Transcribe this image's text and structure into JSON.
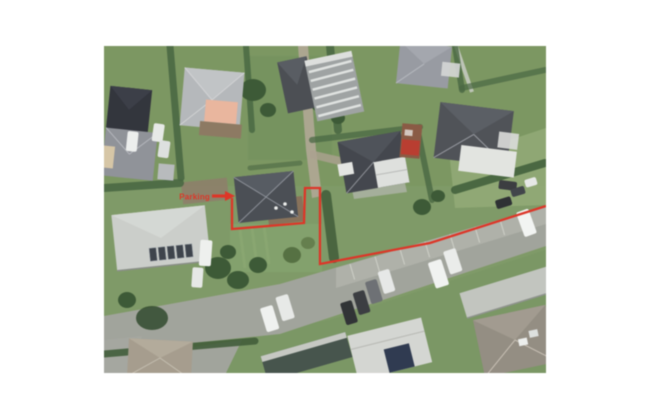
{
  "page": {
    "background_color": "#ffffff",
    "content_type": "aerial-photo-with-boundary-overlay"
  },
  "overlay": {
    "color": "#e93223",
    "label": "Parking",
    "boundary_points": "232,198 232,229 304,223 305,188 320,188 320,264 430,243 546,206",
    "arrow_shaft_points": "212,196 227,196",
    "arrow_head_points": "225,191 235,196 225,201"
  },
  "palette": {
    "grass": "#7e9b64",
    "grass_light": "#93ae74",
    "road": "#a2a59c",
    "parking_strip": "#b0b2a9",
    "hedge": "#476840",
    "roof_dark": "#4a4e55",
    "roof_light": "#ccd0cb"
  }
}
